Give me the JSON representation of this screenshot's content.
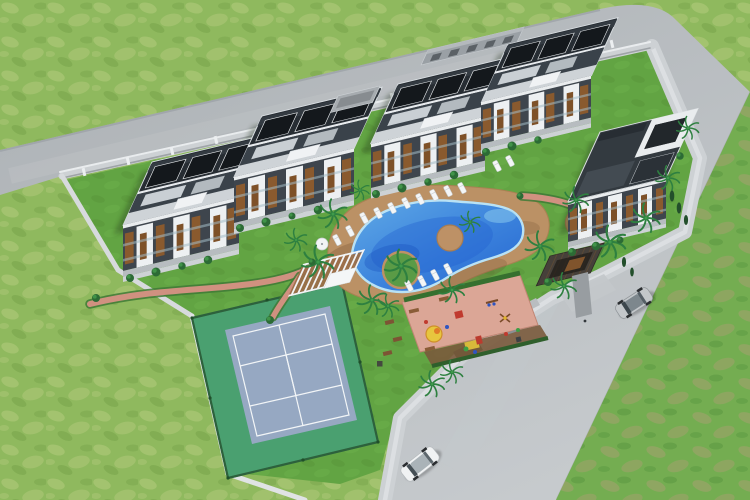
{
  "scene": {
    "type": "aerial-3d-architectural-render",
    "description": "Bird's-eye 3D visualization of a gated residential villa complex with shared amenities, bordered by two asphalt roads and open grass fields",
    "features": [
      "five modern villas with dark curved roofs and white balcony frames",
      "free-form swimming pool with planted island and round sun deck",
      "separate round kiddie pool",
      "white pergola lounge on wood deck",
      "tennis court with green surround and blue-gray surface",
      "children playground on salmon paving",
      "entrance gatehouse with dark timber roof",
      "perimeter wall with pillars",
      "two cars on the road",
      "palm trees, hedges and lawns"
    ],
    "counts": {
      "villas": 5,
      "pools": 2,
      "tennis_courts": 1,
      "playgrounds": 1,
      "pergolas": 1,
      "gatehouses": 1,
      "cars": 2,
      "roads": 2
    }
  },
  "palette": {
    "grassOuter": "#8fb95e",
    "grassOuterPatch": "#a8c573",
    "grassOuterDark": "#79a54b",
    "grassField2": "#74ad51",
    "grassPatch2": "#a5a06f",
    "lawn": "#62a443",
    "lawnShade": "#549238",
    "road": "#b2b7bb",
    "roadLight": "#c6cacd",
    "sidewalk": "#dadde0",
    "wall": "#cdd1d4",
    "roofDark": "#272d33",
    "roofPanel": "#ced3d7",
    "wallCharcoal": "#3e454d",
    "facadeWhite": "#edf0f2",
    "windowAmber": "#8a5a2e",
    "poolDeep": "#2565d0",
    "poolLight": "#5fa9e6",
    "waterline": "#b9e2f5",
    "deckTan": "#bd9166",
    "pathSalmon": "#d09180",
    "playPave": "#dba696",
    "hedge": "#3f7a36",
    "palmGreen": "#2e8040",
    "courtBlue": "#96a8c2",
    "courtGreen": "#4aa070",
    "carSilver": "#c3c7ca",
    "carWhite": "#f0f2f3",
    "gateRoof": "#46403a"
  }
}
